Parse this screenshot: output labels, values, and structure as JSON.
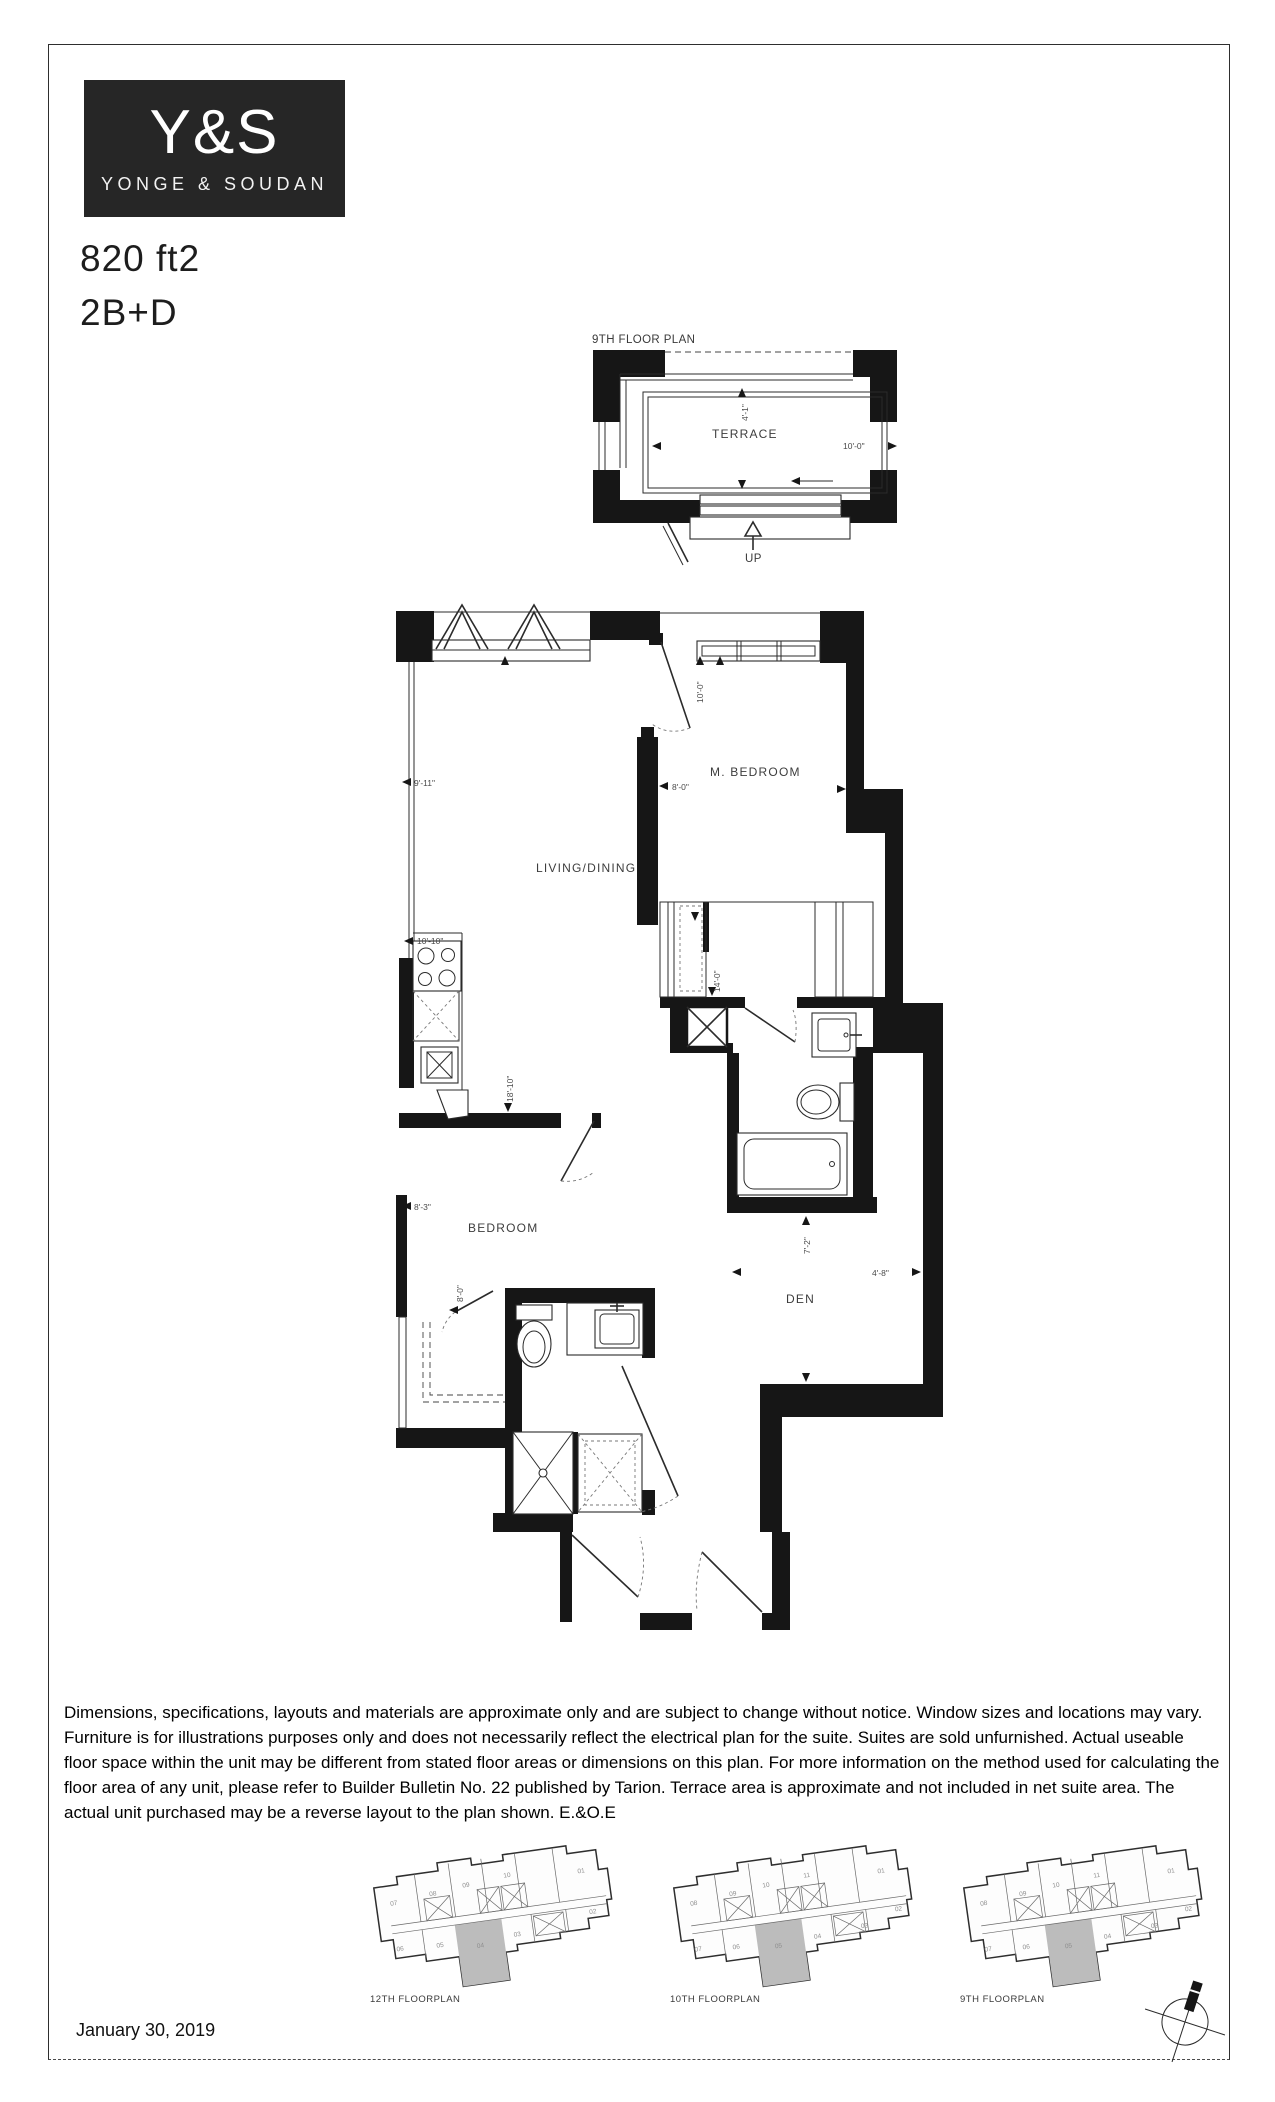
{
  "brand": {
    "abbr": "Y&S",
    "name": "YONGE & SOUDAN"
  },
  "unit": {
    "area": "820 ft2",
    "layout": "2B+D"
  },
  "terrace_plan": {
    "title": "9TH FLOOR PLAN",
    "room": "TERRACE",
    "width_dim": "10'-0\"",
    "depth_dim": "4'-1\"",
    "stairs_label": "UP"
  },
  "floor_plan": {
    "rooms": {
      "living": "LIVING/DINING",
      "master": "M. BEDROOM",
      "bedroom": "BEDROOM",
      "den": "DEN"
    },
    "dims": {
      "living_width": "9'-11\"",
      "living_length": "18'-10\"",
      "master_width": "8'-0\"",
      "master_depth": "10'-0\"",
      "kitchen": "10'-10\"",
      "closet_run": "14'-0\"",
      "bedroom_width": "8'-3\"",
      "bedroom_closet": "8'-0\"",
      "den_depth": "7'-2\"",
      "den_width": "4'-8\""
    }
  },
  "disclaimer": "Dimensions, specifications, layouts and materials are approximate only and are subject to change without notice. Window sizes and locations may vary. Furniture is for illustrations purposes only and does not necessarily reflect the electrical plan for the suite. Suites are sold unfurnished. Actual useable floor space within the unit may be different from stated floor areas or dimensions on this plan. For more information on the method used for calculating the floor area of any unit, please refer to Builder Bulletin No. 22 published by Tarion. Terrace area is approximate and not included in net suite area. The actual unit purchased may be a reverse layout to the plan shown. E.&O.E",
  "key_plans": [
    {
      "label": "12TH FLOORPLAN",
      "highlight_unit": "04",
      "units_top": [
        "07",
        "08",
        "09",
        "10",
        "01"
      ],
      "units_bottom": [
        "06",
        "05",
        "04",
        "03",
        "02"
      ]
    },
    {
      "label": "10TH FLOORPLAN",
      "highlight_unit": "05",
      "units_top": [
        "08",
        "09",
        "10",
        "11",
        "01"
      ],
      "units_bottom": [
        "07",
        "06",
        "05",
        "04",
        "03",
        "02"
      ]
    },
    {
      "label": "9TH FLOORPLAN",
      "highlight_unit": "05",
      "units_top": [
        "08",
        "09",
        "10",
        "11",
        "01"
      ],
      "units_bottom": [
        "07",
        "06",
        "05",
        "04",
        "03",
        "02"
      ]
    }
  ],
  "date": "January 30, 2019",
  "colors": {
    "wall": "#161616",
    "highlight": "#bcbcbc",
    "logo_bg": "#262626"
  }
}
